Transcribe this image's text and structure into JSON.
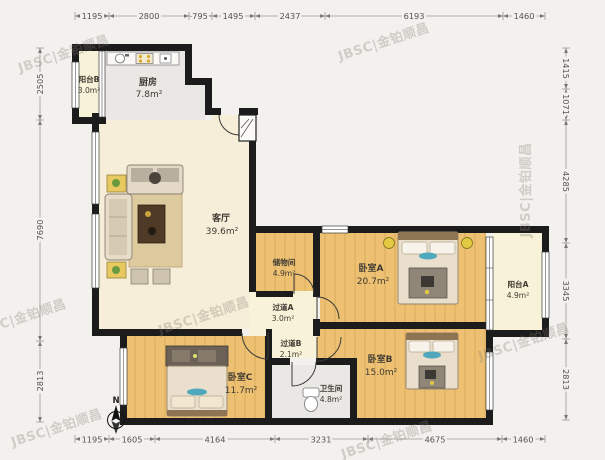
{
  "watermark": {
    "text": "JBSC|金铂顺昌"
  },
  "compass": {
    "label": "N"
  },
  "palette": {
    "wall": "#1c1c1c",
    "wood": "#eec172",
    "cream": "#f6eed8",
    "pale": "#f7f2d8",
    "gray": "#e9e8e4",
    "teal": "#4fa8bc",
    "lamp": "#e4ca43",
    "background": "#f2f1ee"
  },
  "rooms": [
    {
      "id": "balcony-b",
      "name": "阳台B",
      "area": "3.0m²"
    },
    {
      "id": "kitchen",
      "name": "厨房",
      "area": "7.8m²"
    },
    {
      "id": "living-room",
      "name": "客厅",
      "area": "39.6m²"
    },
    {
      "id": "storage",
      "name": "储物间",
      "area": "4.9m²"
    },
    {
      "id": "hallway-a",
      "name": "过道A",
      "area": "3.0m²"
    },
    {
      "id": "hallway-b",
      "name": "过道B",
      "area": "2.1m²"
    },
    {
      "id": "bedroom-a",
      "name": "卧室A",
      "area": "20.7m²"
    },
    {
      "id": "balcony-a",
      "name": "阳台A",
      "area": "4.9m²"
    },
    {
      "id": "bedroom-c",
      "name": "卧室C",
      "area": "11.7m²"
    },
    {
      "id": "bathroom",
      "name": "卫生间",
      "area": "4.8m²"
    },
    {
      "id": "bedroom-b",
      "name": "卧室B",
      "area": "15.0m²"
    }
  ],
  "dimensions": {
    "top": [
      "1195",
      "2800",
      "795",
      "1495",
      "2437",
      "6193",
      "1460"
    ],
    "bottom": [
      "1195",
      "1605",
      "4164",
      "3231",
      "4675",
      "1460"
    ],
    "left": [
      "2505",
      "7690",
      "2813"
    ],
    "right": [
      "1415",
      "1071",
      "4285",
      "3345",
      "2813"
    ]
  }
}
